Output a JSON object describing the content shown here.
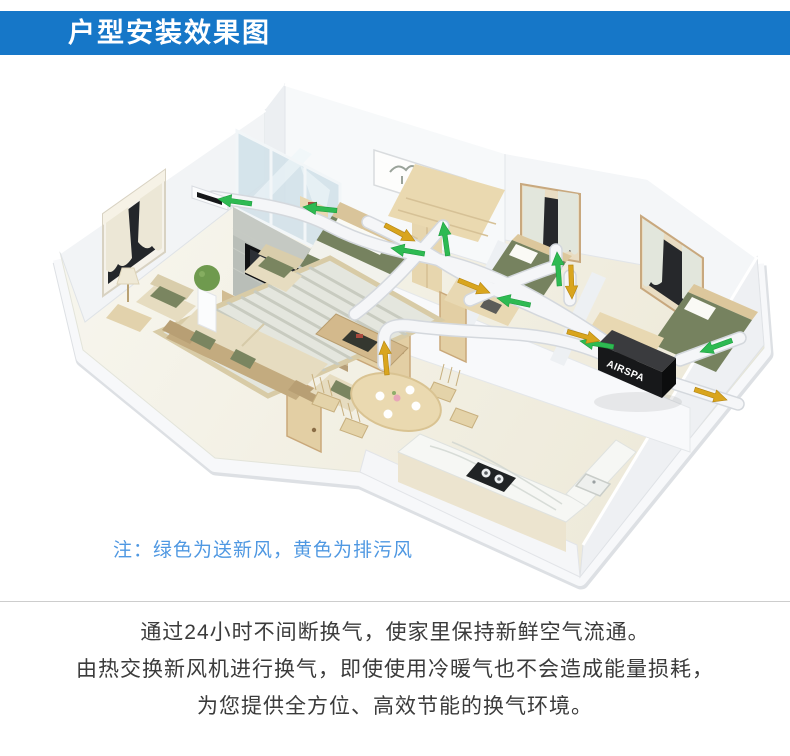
{
  "header": {
    "title": "户型安装效果图",
    "background_color": "#1677c8",
    "text_color": "#ffffff"
  },
  "scene": {
    "unit_label": "AIRSPA",
    "supply_color": "#2eba52",
    "exhaust_color": "#d9a51e",
    "duct_color": "#f5f6f8"
  },
  "note": {
    "text": "注：绿色为送新风，黄色为排污风",
    "color": "#4f98e2"
  },
  "description": {
    "lines": [
      "通过24小时不间断换气，使家里保持新鲜空气流通。",
      "由热交换新风机进行换气，即使使用冷暖气也不会造成能量损耗，",
      "为您提供全方位、高效节能的换气环境。"
    ]
  }
}
